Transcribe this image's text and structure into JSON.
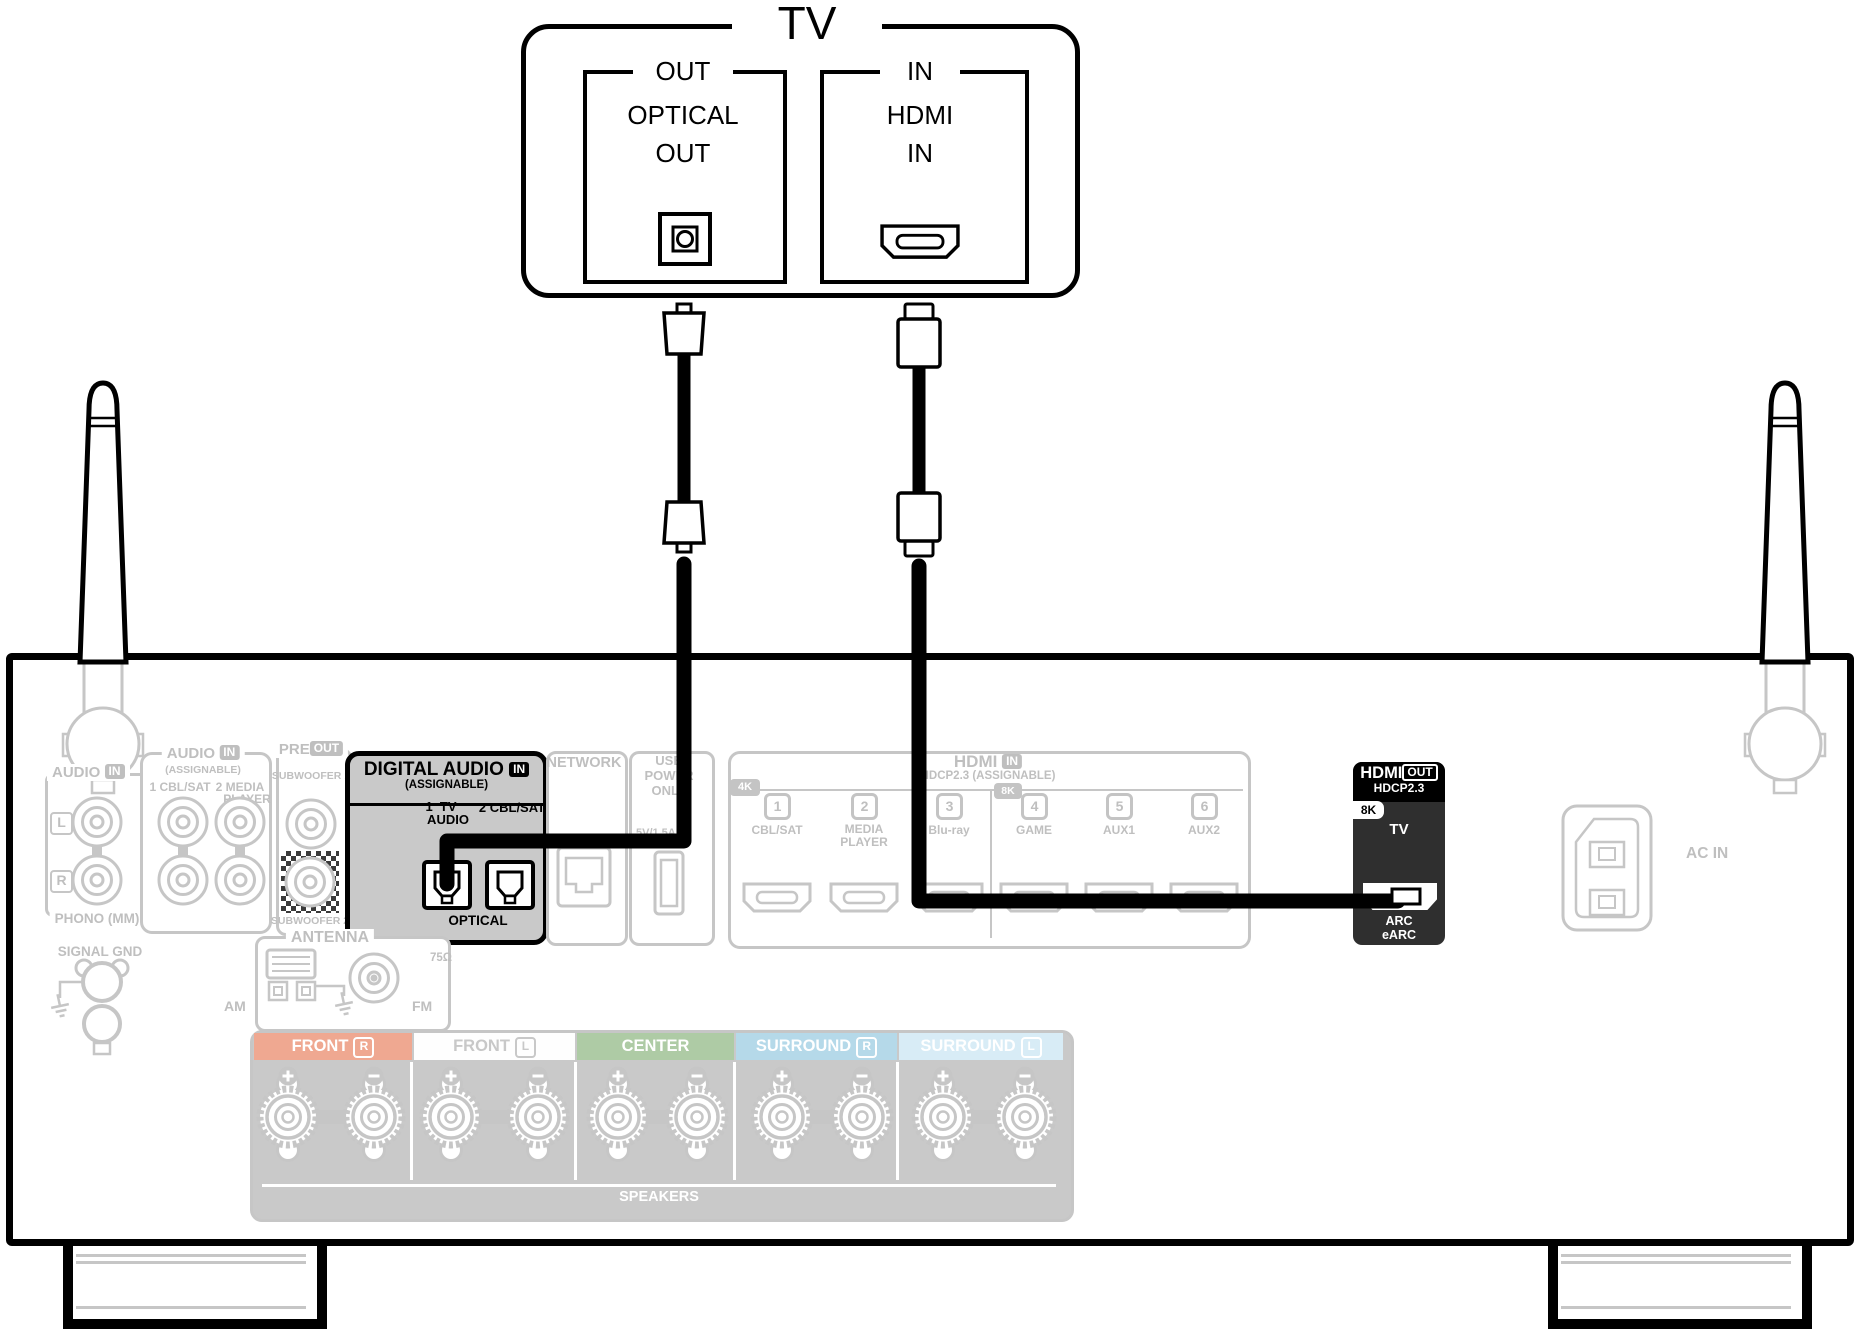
{
  "tv": {
    "title": "TV",
    "out_group": "OUT",
    "optical_line1": "OPTICAL",
    "optical_line2": "OUT",
    "in_group": "IN",
    "hdmi_line1": "HDMI",
    "hdmi_line2": "IN"
  },
  "receiver": {
    "phono": {
      "title": "AUDIO",
      "badge": "IN",
      "left": "L",
      "right": "R",
      "caption": "PHONO (MM)"
    },
    "audio_in": {
      "title": "AUDIO",
      "badge": "IN",
      "subtitle": "(ASSIGNABLE)",
      "col1": "1 CBL/SAT",
      "col2_line1": "2 MEDIA",
      "col2_line2": "PLAYER"
    },
    "pre_out": {
      "title": "PRE",
      "badge": "OUT",
      "sub1": "SUBWOOFER 1",
      "sub2": "SUBWOOFER 2"
    },
    "digital_audio": {
      "title": "DIGITAL AUDIO",
      "badge": "IN",
      "subtitle": "(ASSIGNABLE)",
      "port1_line1": "1  TV",
      "port1_line2": "AUDIO",
      "port2": "2 CBL/SAT",
      "caption": "OPTICAL"
    },
    "network": {
      "title": "NETWORK"
    },
    "usb": {
      "line1": "USB",
      "line2": "POWER",
      "line3": "ONLY",
      "rating": "5V/1.5A"
    },
    "hdmi_in": {
      "title": "HDMI",
      "badge": "IN",
      "subtitle": "HDCP2.3 (ASSIGNABLE)",
      "badge_4k": "4K",
      "badge_8k": "8K",
      "ports": [
        {
          "num": "1",
          "label": "CBL/SAT"
        },
        {
          "num": "2",
          "label": "MEDIA PLAYER"
        },
        {
          "num": "3",
          "label": "Blu-ray"
        },
        {
          "num": "4",
          "label": "GAME"
        },
        {
          "num": "5",
          "label": "AUX1"
        },
        {
          "num": "6",
          "label": "AUX2"
        }
      ]
    },
    "hdmi_out": {
      "title": "HDMI",
      "badge": "OUT",
      "hdcp": "HDCP2.3",
      "badge_8k": "8K",
      "source": "TV",
      "arc_line1": "ARC",
      "arc_line2": "eARC"
    },
    "ac_in": "AC IN",
    "signal_gnd": "SIGNAL GND",
    "antenna": {
      "title": "ANTENNA",
      "am": "AM",
      "fm": "FM",
      "ohm": "75Ω"
    },
    "speakers": {
      "caption": "SPEAKERS",
      "channels": [
        {
          "name": "FRONT",
          "badge": "R",
          "bg": "#efa891",
          "fg": "#ffffff"
        },
        {
          "name": "FRONT",
          "badge": "L",
          "bg": "#fefefe",
          "fg": "#c8c8c8"
        },
        {
          "name": "CENTER",
          "badge": "",
          "bg": "#aecba5",
          "fg": "#ffffff"
        },
        {
          "name": "SURROUND",
          "badge": "R",
          "bg": "#b5d9e9",
          "fg": "#ffffff"
        },
        {
          "name": "SURROUND",
          "badge": "L",
          "bg": "#d8ecf6",
          "fg": "#ffffff"
        }
      ]
    }
  },
  "colors": {
    "highlight": "#000000",
    "faded_stroke": "#c4c4c4",
    "faded_text": "#bfbfbf",
    "panel_gray": "#c9c9c9",
    "hdmi_out_bg": "#2f2f2f"
  }
}
